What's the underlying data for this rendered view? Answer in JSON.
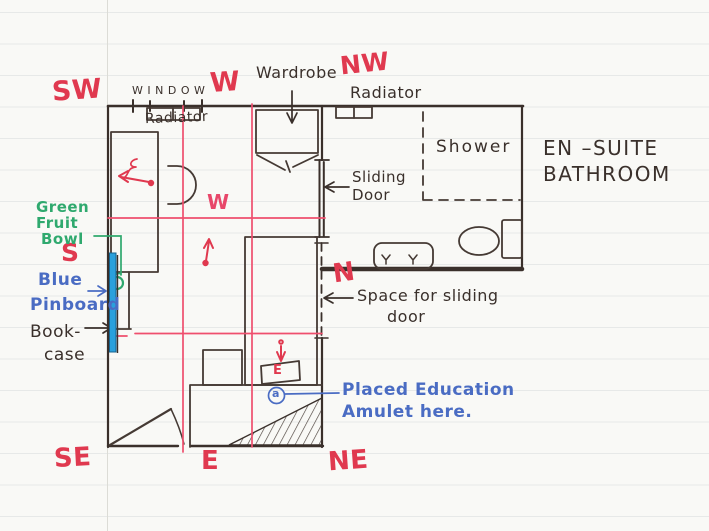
{
  "title": "Bedroom and en-suite bathroom feng shui floor plan sketch",
  "compass": {
    "sw": "SW",
    "west_top": "W",
    "nw": "NW",
    "south": "S",
    "west_mid": "W",
    "north": "N",
    "se": "SE",
    "east_bottom": "E",
    "ne": "NE"
  },
  "rooms": {
    "ensuite_line1": "EN –SUITE",
    "ensuite_line2": "BATHROOM",
    "shower": "Shower",
    "window": "WINDOW",
    "radiator_window": "Radiator",
    "radiator_ensuite": "Radiator",
    "wardrobe": "Wardrobe",
    "sliding_door_line1": "Sliding",
    "sliding_door_line2": "Door",
    "sliding_space_line1": "Space for sliding",
    "sliding_space_line2": "door"
  },
  "annotations": {
    "green_fruit_bowl": [
      "Green",
      "Fruit",
      "Bowl"
    ],
    "blue_pinboard": [
      "Blue",
      "Pinboard"
    ],
    "bookcase": [
      "Book-",
      "case"
    ],
    "amulet": [
      "Placed  Education",
      "Amulet here."
    ]
  },
  "markers": {
    "bed_e": "E",
    "amulet_a": "a"
  },
  "colors": {
    "red_ink": "#e0394f",
    "grid_pink": "#ef4f6e",
    "black_ink": "#3a302b",
    "green_ink": "#2fa96e",
    "blue_ink": "#4a6cc3",
    "pinboard_blue": "#2aa0dc",
    "paper": "#f9f9f6"
  }
}
